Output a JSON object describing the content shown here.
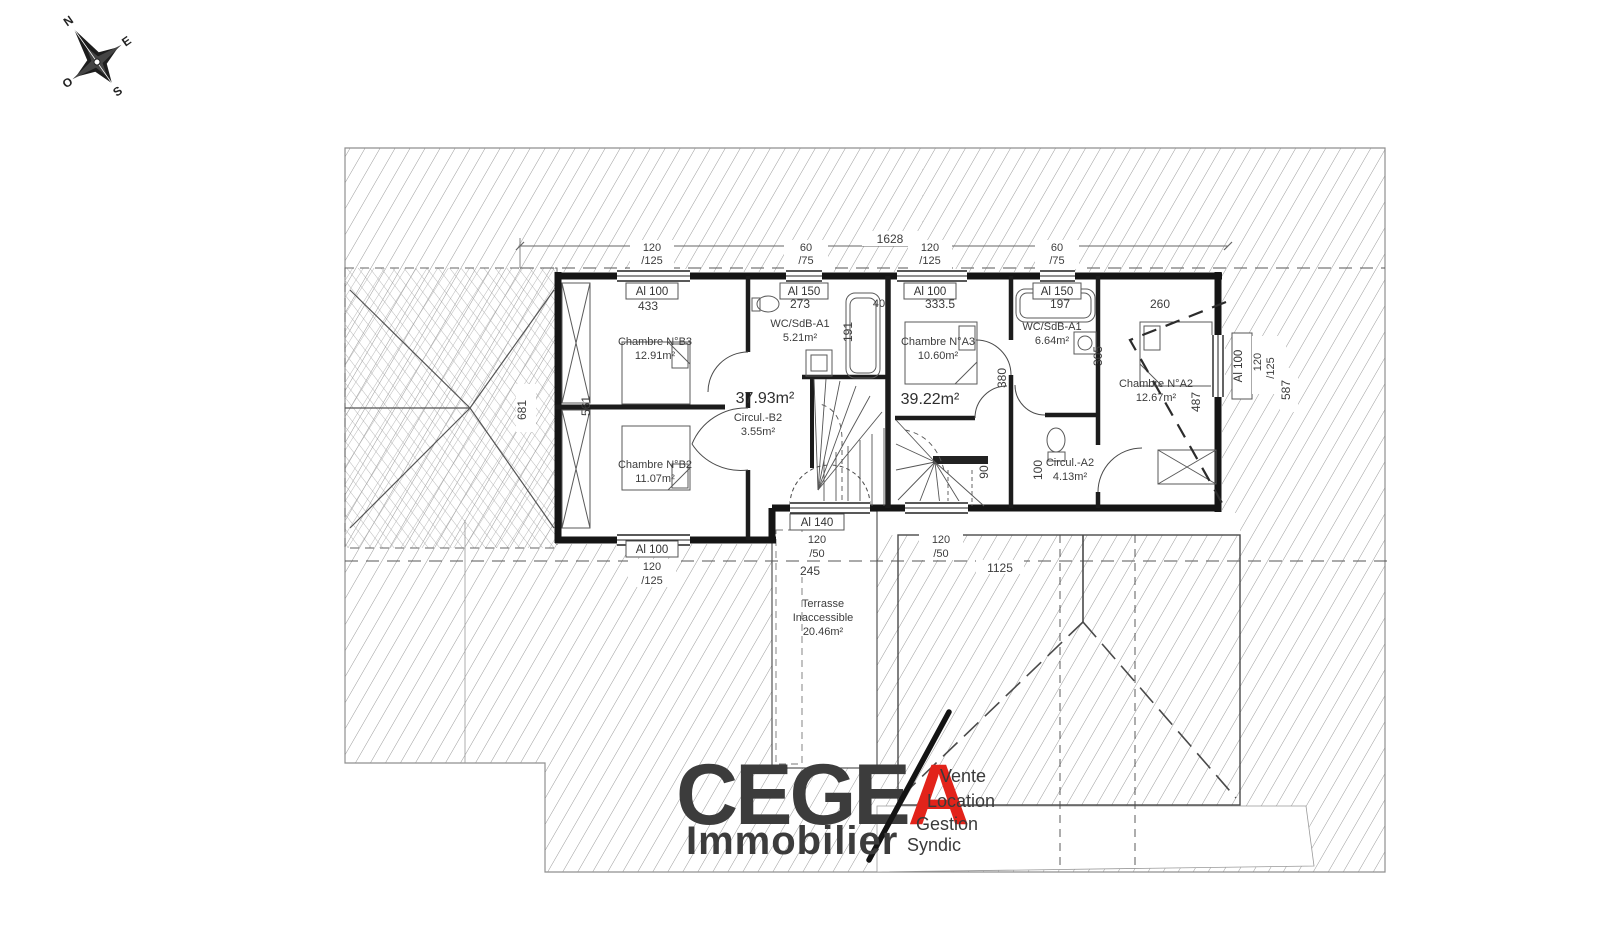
{
  "title": "Plan d'étage",
  "compass": {
    "n": "N",
    "e": "E",
    "s": "S",
    "o": "O"
  },
  "windows": {
    "al100": "Al 100",
    "al150": "Al 150",
    "al140": "Al 140"
  },
  "dims": {
    "total": "1628",
    "d120": "120",
    "d125": "/125",
    "d60": "60",
    "d75": "/75",
    "d50": "/50",
    "d433": "433",
    "d273": "273",
    "d3335": "333.5",
    "d197": "197",
    "d260": "260",
    "d191": "191",
    "d40": "40",
    "d380": "380",
    "d305": "305",
    "d487": "487",
    "d587": "587",
    "d561": "561",
    "d681": "681",
    "d90": "90",
    "d100": "100",
    "d245": "245",
    "d1125": "1125"
  },
  "rooms": {
    "b3": {
      "name": "Chambre N°B3",
      "area": "12.91m²"
    },
    "b2": {
      "name": "Chambre N°B2",
      "area": "11.07m²"
    },
    "a3": {
      "name": "Chambre N°A3",
      "area": "10.60m²"
    },
    "a2": {
      "name": "Chambre N°A2",
      "area": "12.67m²"
    },
    "wc_b": {
      "name": "WC/SdB-A1",
      "area": "5.21m²"
    },
    "wc_a": {
      "name": "WC/SdB-A1",
      "area": "6.64m²"
    },
    "circ_b": {
      "name": "Circul.-B2",
      "area": "3.55m²"
    },
    "circ_a": {
      "name": "Circul.-A2",
      "area": "4.13m²"
    },
    "zone_b": {
      "area": "37.93m²"
    },
    "zone_a": {
      "area": "39.22m²"
    },
    "terrasse": {
      "line1": "Terrasse",
      "line2": "Inaccessible",
      "area": "20.46m²"
    }
  },
  "logo": {
    "main": "CEGE",
    "accent": "A",
    "subtitle": "Immobilier",
    "services": {
      "s1": "Vente",
      "s2": "Location",
      "s3": "Gestion",
      "s4": "Syndic"
    },
    "color_dark": "#28272e",
    "color_red": "#e2231a"
  }
}
